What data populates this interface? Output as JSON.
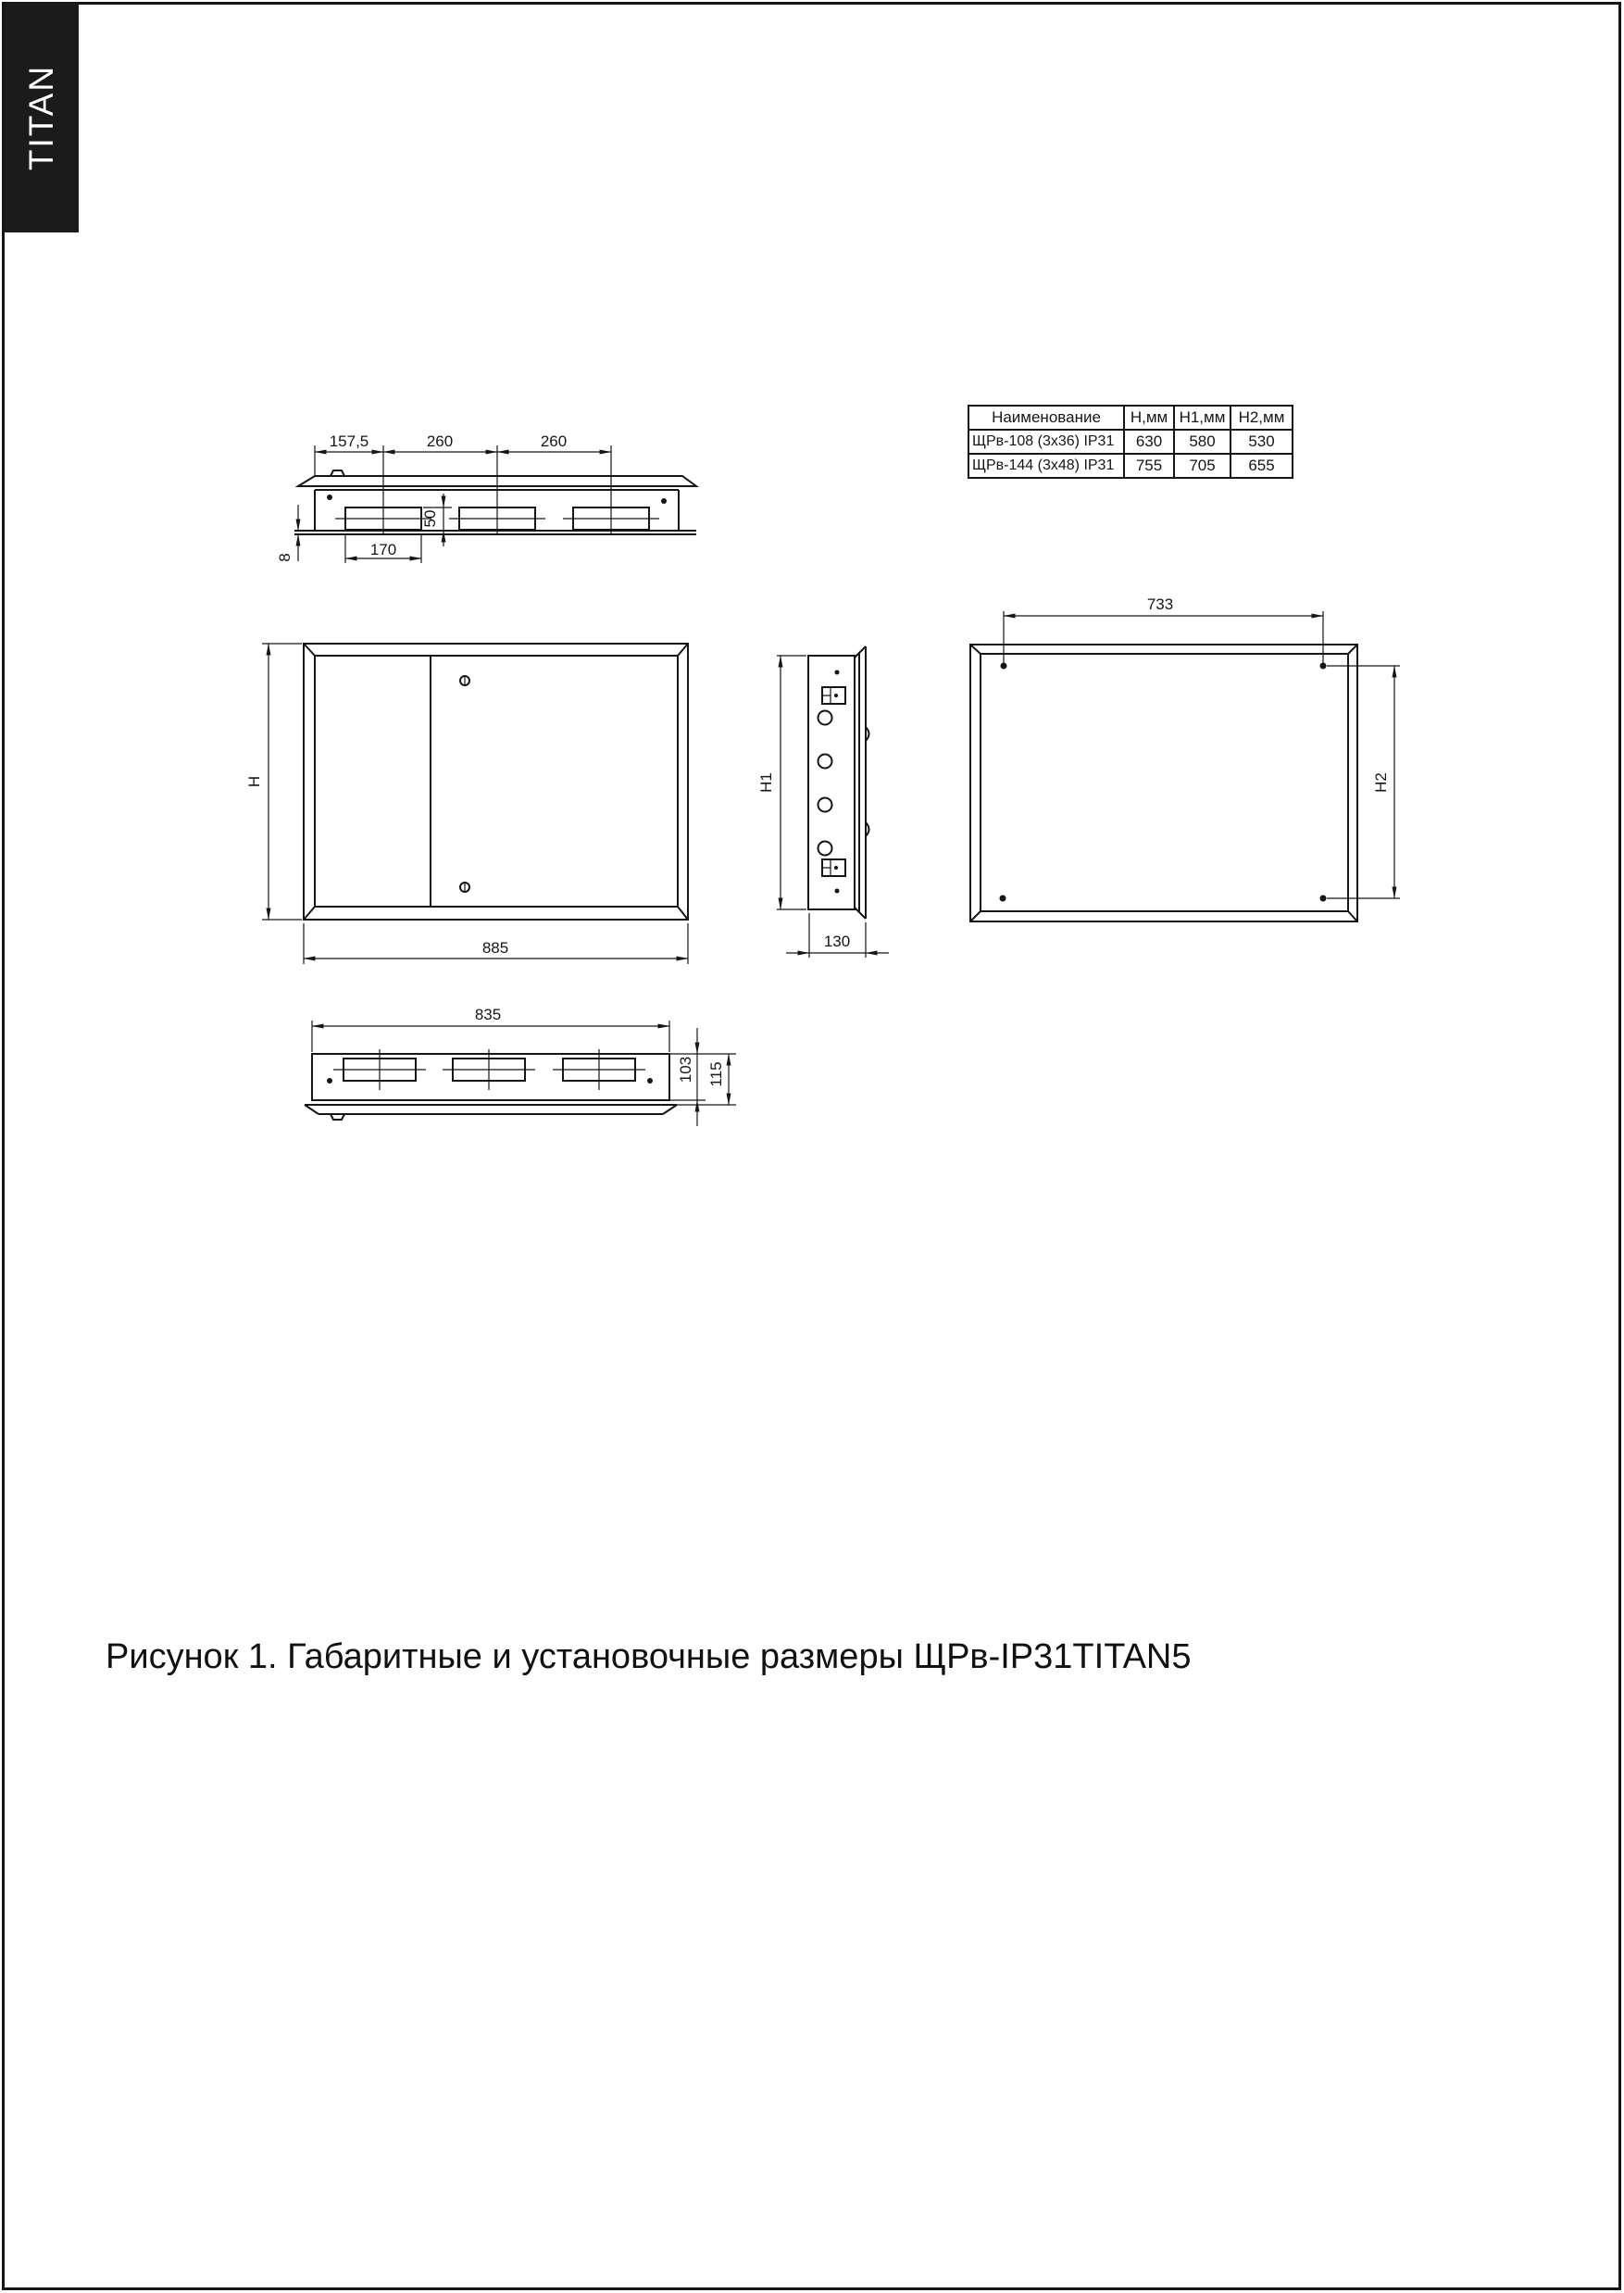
{
  "logo": {
    "text": "TITAN"
  },
  "table": {
    "headers": [
      "Наименование",
      "H,мм",
      "H1,мм",
      "H2,мм"
    ],
    "rows": [
      [
        "ЩРв-108 (3х36) IP31",
        "630",
        "580",
        "530"
      ],
      [
        "ЩРв-144 (3х48) IP31",
        "755",
        "705",
        "655"
      ]
    ]
  },
  "dims": {
    "top_view": {
      "left_offset": "157,5",
      "pitch1": "260",
      "pitch2": "260",
      "knockout_height": "50",
      "knockout_width": "170",
      "lip": "8"
    },
    "front_view": {
      "height": "H",
      "width": "885"
    },
    "side_view": {
      "height": "H1",
      "depth": "130"
    },
    "rear_view": {
      "mount_width": "733",
      "mount_height": "H2"
    },
    "bottom_view": {
      "width": "835",
      "body_depth": "103",
      "total_depth": "115"
    }
  },
  "caption": {
    "text": "Рисунок 1. Габаритные и установочные размеры ЩРв-IP31TITAN5"
  }
}
